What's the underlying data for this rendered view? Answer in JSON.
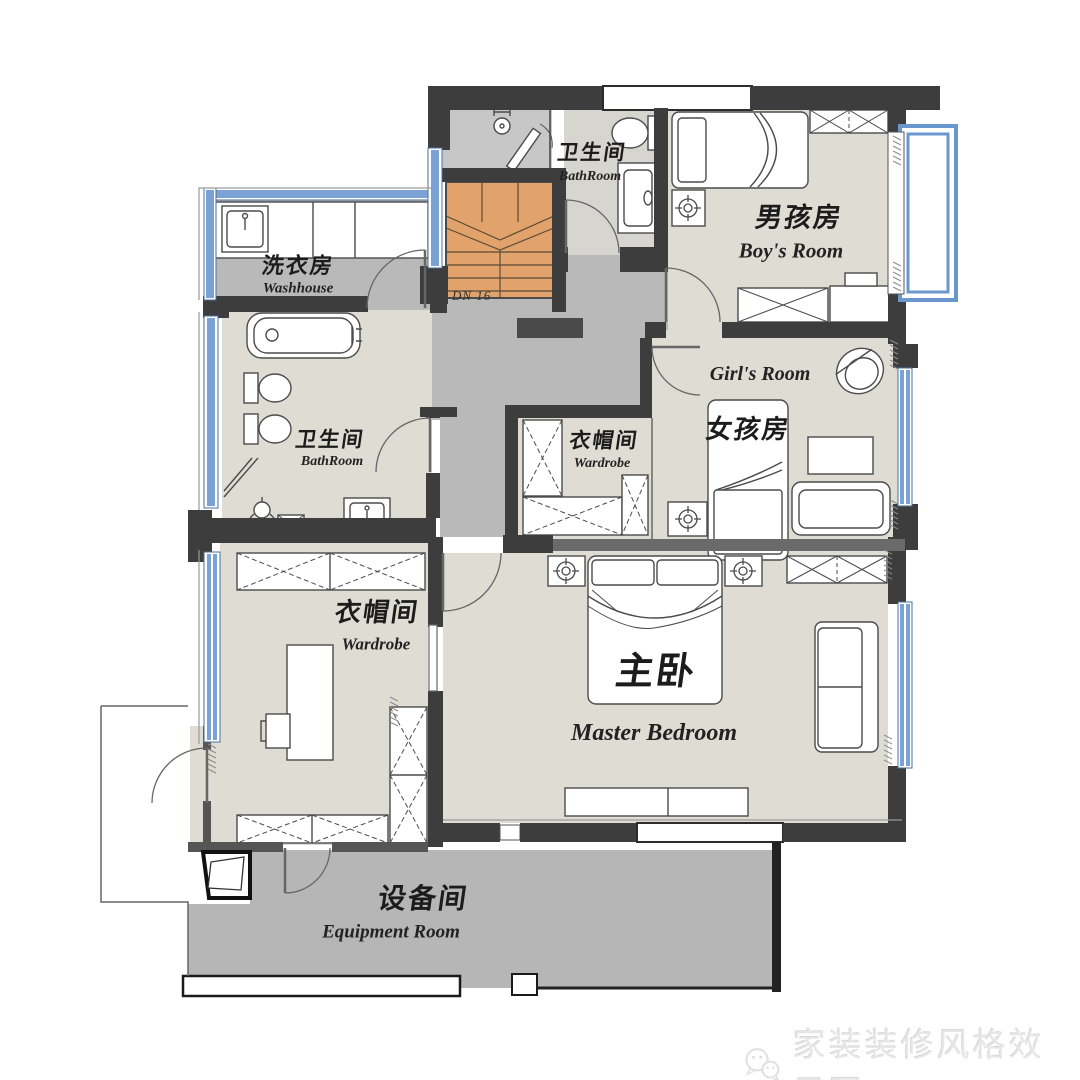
{
  "rooms": {
    "washhouse": {
      "cn": "洗衣房",
      "en": "Washhouse"
    },
    "bathroom_top": {
      "cn": "卫生间",
      "en": "BathRoom"
    },
    "boys_room": {
      "cn": "男孩房",
      "en": "Boy's Room"
    },
    "girls_room": {
      "cn": "女孩房",
      "en": "Girl's Room"
    },
    "wardrobe_mid": {
      "cn": "衣帽间",
      "en": "Wardrobe"
    },
    "bathroom_left": {
      "cn": "卫生间",
      "en": "BathRoom"
    },
    "wardrobe_left": {
      "cn": "衣帽间",
      "en": "Wardrobe"
    },
    "master_bedroom": {
      "cn": "主卧",
      "en": "Master Bedroom"
    },
    "equipment_room": {
      "cn": "设备间",
      "en": "Equipment Room"
    }
  },
  "stairs": {
    "note": "DN 16"
  },
  "watermark": {
    "text": "家装装修风格效果图",
    "icon": "wechat-icon"
  },
  "colors": {
    "wall_dark": "#3d3d3d",
    "wall_mid": "#6a6a6a",
    "floor_light": "#dedcd3",
    "floor_gray": "#b9b9b9",
    "stairs_fill": "#e1a36b",
    "window_blue": "#7ba2d4",
    "furniture_outline": "#4b4b4b"
  }
}
